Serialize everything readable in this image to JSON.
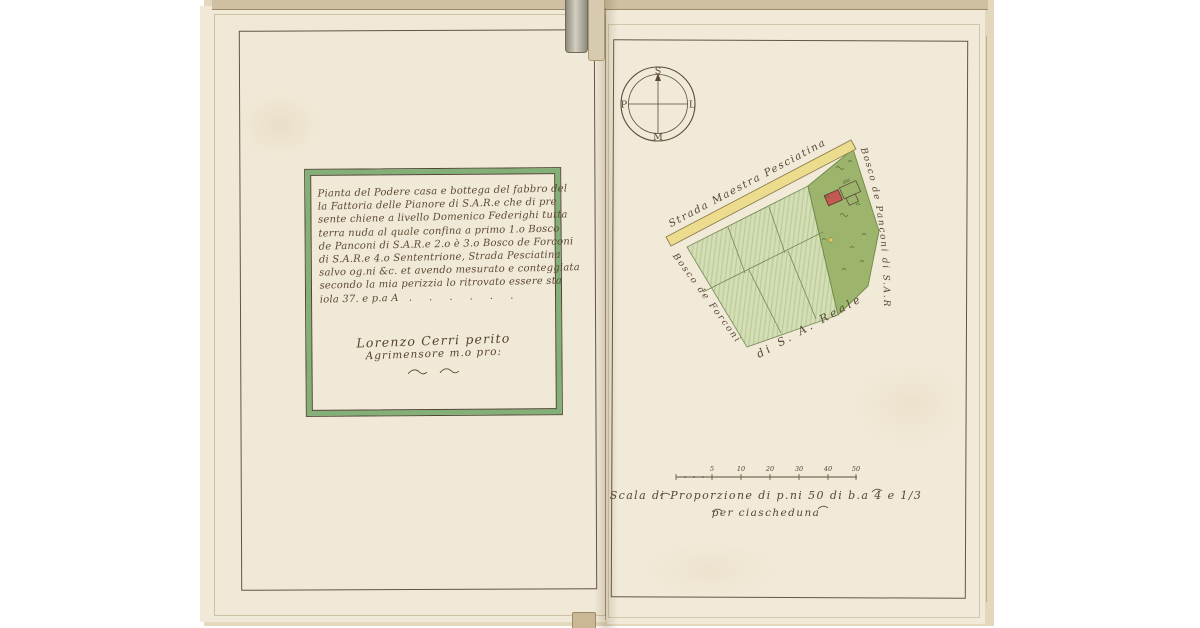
{
  "colors": {
    "paper": "#f1e9d7",
    "ink": "#554634",
    "green_border": "#82b077",
    "field_green": "#d4deb6",
    "field_stripe": "#b9c994",
    "wood_green": "#9cb46c",
    "road_yellow": "#ecdc8e",
    "building_red": "#c25a52"
  },
  "left_page": {
    "description_lines": [
      "Pianta del Podere casa e bottega del fabbro del",
      "la Fattoria delle Pianore di S.A.R.e che di pre",
      "sente chiene a livello Domenico Federighi tutta",
      "terra nuda al quale confina a primo 1.o Bosco",
      "de Panconi di S.A.R.e 2.o è 3.o Bosco de Forconi",
      "di S.A.R.e 4.o Sententrione, Strada Pesciatina",
      "salvo og.ni &c. et avendo mesurato e conteggiata",
      "secondo la mia perizzia lo ritrovato essere sta",
      "iola 37. e p.a A   .     .     .     .     .     ."
    ],
    "signature_line1": "Lorenzo Cerri perito",
    "signature_line2": "Agrimensore m.o pro:"
  },
  "right_page": {
    "compass": {
      "top": "S",
      "bottom": "M",
      "left": "P",
      "right": "L"
    },
    "map_labels": {
      "road": "Strada Maestra Pesciatina",
      "right_edge": "Bosco de Panconi di S.A.R.",
      "left_edge": "Bosco de Forconi",
      "bottom_edge": "di S. A. Reale",
      "courtyard": "aia"
    },
    "scale": {
      "tick_labels": [
        "5",
        "10",
        "20",
        "30",
        "40",
        "50"
      ],
      "caption_line1": "Scala di Proporzione di p.ni 50 di b.a 4 e 1/3",
      "caption_line2": "per ciascheduna"
    }
  }
}
